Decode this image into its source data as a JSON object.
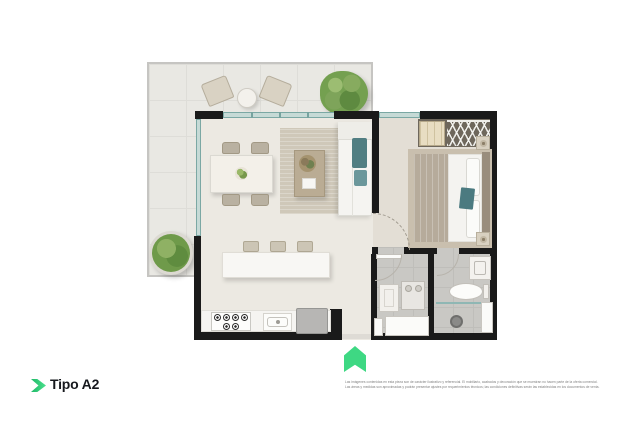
{
  "branding": {
    "plan_label": "Tipo A2",
    "accent_green": "#3ed883",
    "accent_green_dark": "#1fb868",
    "label_color": "#16181d"
  },
  "entrance_marker": {
    "icon": "entrance-arrow-icon",
    "color": "#3ed883"
  },
  "disclaimer": {
    "line1": "Las imágenes contenidas en esta pieza son de carácter ilustrativo y referencial. El mobiliario, acabados y decoración que se muestran no hacen parte de la oferta comercial.",
    "line2": "Las áreas y medidas son aproximadas y podrán presentar ajustes por requerimientos técnicos; las condiciones definitivas serán las establecidas en los documentos de venta."
  },
  "floorplan": {
    "type": "apartment-floor-plan",
    "unit": "Tipo A2",
    "rooms": [
      "terraza",
      "sala-comedor",
      "cocina",
      "habitacion",
      "bano",
      "zona-de-lavado"
    ],
    "wall_color": "#1a1a1a",
    "glass_color": "#7ba8a4",
    "floor_colors": {
      "terrace": "#e9e8e3",
      "living": "#ece9e2",
      "bedroom": "#e3ded5",
      "bathroom": "#c9c8c4"
    }
  }
}
